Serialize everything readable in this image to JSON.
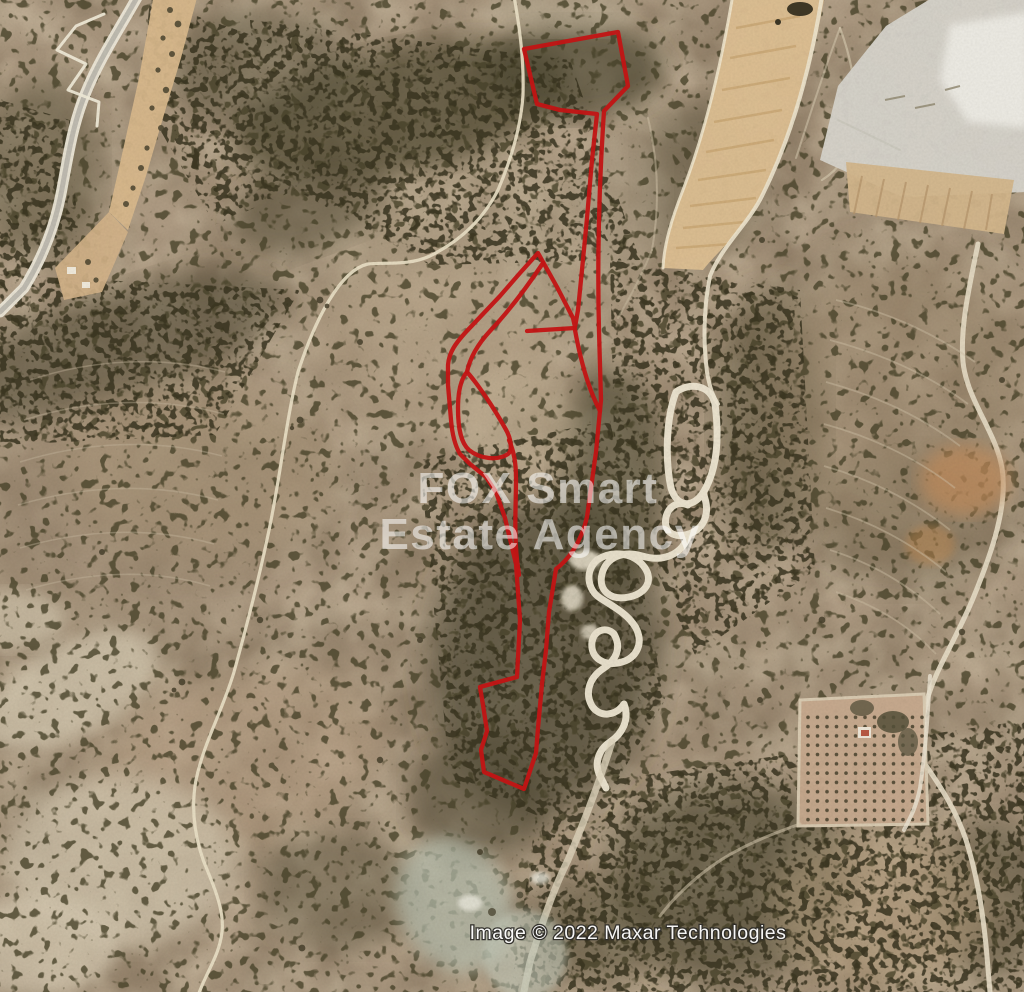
{
  "map": {
    "provider_watermark": {
      "line1": "FOX Smart",
      "line2": "Estate Agency"
    },
    "attribution": "Image © 2022 Maxar Technologies",
    "parcel": {
      "stroke_color": "#c21414",
      "paths": {
        "main": "M 524 49 L 618 32 L 628 86 L 604 111 C 600 170 597 250 599 331 L 601 400 L 596 452 L 587 517 C 581 543 568 560 556 569 L 549 612 L 546 650 L 542 684 L 538 728 L 536 753 L 524 789 L 484 772 L 481 750 L 487 731 L 483 705 L 480 687 L 517 677 L 520 620 L 516 564 L 505 518 L 496 492 L 486 477 L 470 464 L 460 454 C 454 444 452 432 451 420 L 448 385 L 448 365 C 449 352 456 343 465 333 L 482 315 L 500 296 L 520 273 L 538 253 L 557 287 L 573 318 L 575 327 L 578 310 L 582 270 L 587 218 L 592 160 L 597 114 L 560 110 L 537 104 Z",
        "sail_bottom": "M 575 328 L 527 331",
        "neck_merge": "M 575 330 C 581 363 590 392 600 411",
        "inner_curve": "M 543 263 C 527 287 508 312 490 331 C 478 344 470 357 467 372",
        "teardrop": "M 467 372 C 477 383 494 408 505 428 C 511 438 513 450 508 454 C 498 461 480 459 469 450 C 461 443 458 429 458 408 C 458 391 461 379 467 372 Z",
        "stem": "M 509 440 C 514 452 516 463 516 478 C 516 505 514 530 517 560 L 519 575"
      }
    },
    "palette": {
      "terrain_base": "#ad9a82",
      "scrub_dark": "#4c4731",
      "dirt_strip": "#dcbe92",
      "quarry_pale": "#d5d2c9",
      "track_white": "#eee6d2",
      "watermark_white": "#ffffff"
    }
  }
}
